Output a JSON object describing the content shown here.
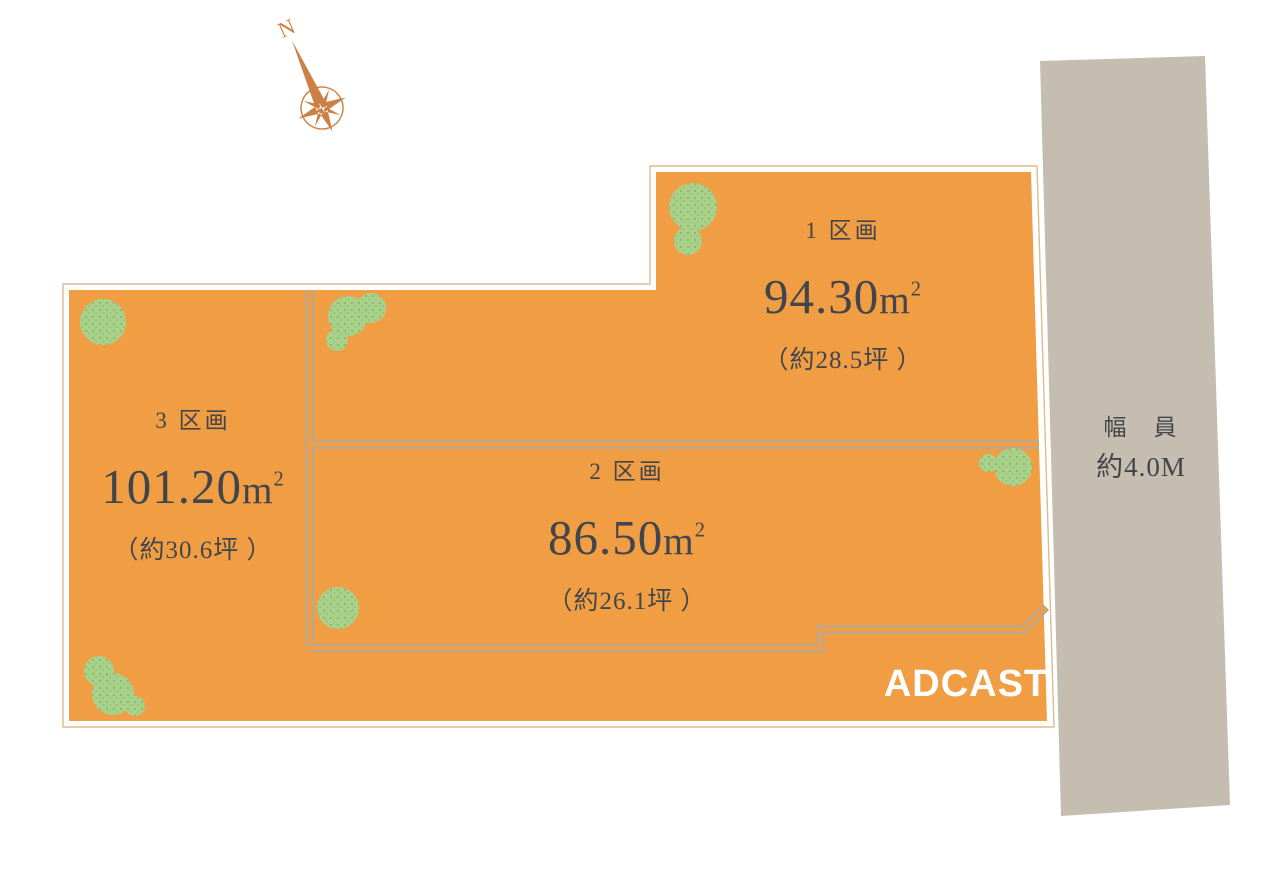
{
  "compass": {
    "north_label": "N"
  },
  "parcels": [
    {
      "name": "1 区画",
      "area_value": "94.30",
      "area_unit_base": "m",
      "area_unit_exp": "2",
      "tsubo": "（約28.5坪 ）"
    },
    {
      "name": "2 区画",
      "area_value": "86.50",
      "area_unit_base": "m",
      "area_unit_exp": "2",
      "tsubo": "（約26.1坪 ）"
    },
    {
      "name": "3 区画",
      "area_value": "101.20",
      "area_unit_base": "m",
      "area_unit_exp": "2",
      "tsubo": "（約30.6坪 ）"
    }
  ],
  "road": {
    "label_width": "幅　員",
    "label_value": "約4.0M"
  },
  "branding": {
    "logo_text": "ADCAST"
  },
  "colors": {
    "parcel_fill": "#f19d44",
    "road_fill": "#c6bdb1",
    "text": "#42464b",
    "compass": "#cd8045",
    "tree": "#a9d18c",
    "divider": "#b2a99b",
    "outline": "#ddbb8f",
    "logo_text": "#ffffff"
  }
}
